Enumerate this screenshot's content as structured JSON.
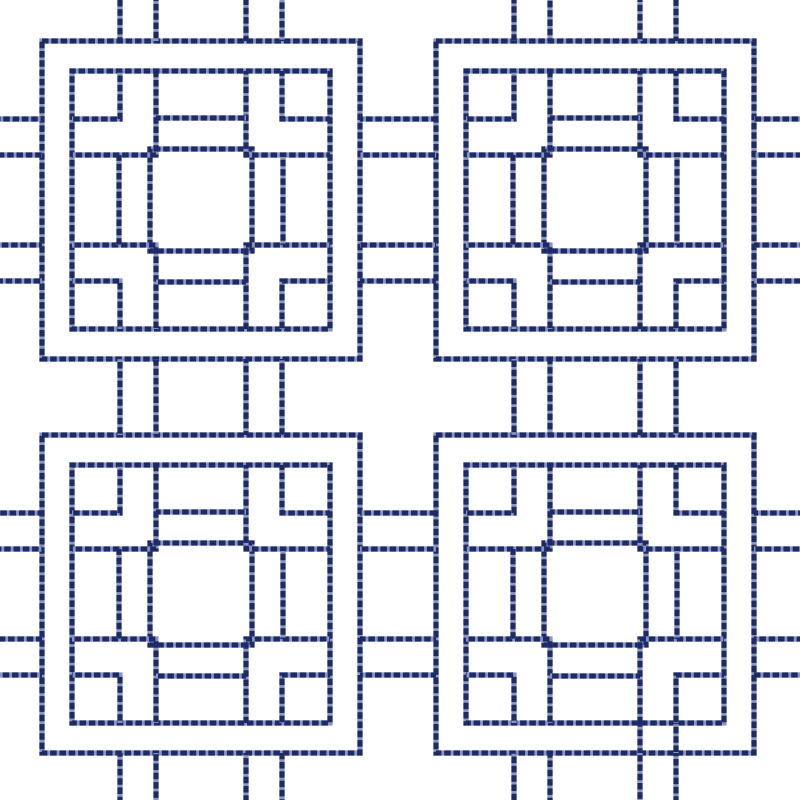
{
  "pattern": {
    "name": "square-maze-lattice-stitch-pattern",
    "background": "#ffffff",
    "viewbox": "0 0 800 800",
    "thread": {
      "dark": "#1d2a66",
      "light": "#8a95c2",
      "width": 5.2,
      "dash_on": 6.5,
      "dash_off": 2.8
    },
    "motif": {
      "size": 318,
      "rects": [
        {
          "name": "outer-square",
          "x": 0,
          "y": 0,
          "w": 318,
          "h": 318
        },
        {
          "name": "inner-ring",
          "x": 30,
          "y": 30,
          "w": 258,
          "h": 258
        },
        {
          "name": "center-square",
          "x": 108,
          "y": 108,
          "w": 102,
          "h": 102
        }
      ],
      "polylines": [
        {
          "name": "corner-key-top-left",
          "pts": [
            [
              30,
              78
            ],
            [
              78,
              78
            ],
            [
              78,
              30
            ]
          ]
        },
        {
          "name": "corner-key-top-right",
          "pts": [
            [
              240,
              30
            ],
            [
              240,
              78
            ],
            [
              288,
              78
            ]
          ]
        },
        {
          "name": "corner-key-bottom-right",
          "pts": [
            [
              288,
              240
            ],
            [
              240,
              240
            ],
            [
              240,
              288
            ]
          ]
        },
        {
          "name": "corner-key-bottom-left",
          "pts": [
            [
              78,
              288
            ],
            [
              78,
              240
            ],
            [
              30,
              240
            ]
          ]
        },
        {
          "name": "rail-top-left",
          "pts": [
            [
              114,
              30
            ],
            [
              114,
              114
            ],
            [
              30,
              114
            ]
          ]
        },
        {
          "name": "rail-top-right",
          "pts": [
            [
              204,
              30
            ],
            [
              204,
              114
            ],
            [
              288,
              114
            ]
          ]
        },
        {
          "name": "rail-bottom-right",
          "pts": [
            [
              288,
              204
            ],
            [
              204,
              204
            ],
            [
              204,
              288
            ]
          ]
        },
        {
          "name": "rail-bottom-left",
          "pts": [
            [
              114,
              288
            ],
            [
              114,
              204
            ],
            [
              30,
              204
            ]
          ]
        }
      ],
      "lines": [
        {
          "name": "rung-top",
          "x1": 114,
          "y1": 77,
          "x2": 204,
          "y2": 77
        },
        {
          "name": "rung-right",
          "x1": 241,
          "y1": 114,
          "x2": 241,
          "y2": 204
        },
        {
          "name": "rung-bottom",
          "x1": 114,
          "y1": 241,
          "x2": 204,
          "y2": 241
        },
        {
          "name": "rung-left",
          "x1": 77,
          "y1": 114,
          "x2": 77,
          "y2": 204
        }
      ]
    },
    "layout": {
      "canvas": 800,
      "origins": [
        [
          42,
          41
        ],
        [
          436,
          41
        ],
        [
          42,
          435
        ],
        [
          436,
          435
        ]
      ],
      "offsets": [
        78,
        114,
        204,
        240
      ],
      "col_x": [
        42,
        436
      ],
      "row_y": [
        41,
        435
      ],
      "h_connector_x": [
        360,
        436
      ],
      "v_connector_y": [
        359,
        435
      ],
      "edge_stub": {
        "top": [
          0,
          41
        ],
        "bottom": [
          753,
          800
        ],
        "left": [
          0,
          42
        ],
        "right": [
          754,
          800
        ]
      },
      "travel_segments": [
        {
          "x1": 640,
          "y1": 723,
          "x2": 640,
          "y2": 753
        },
        {
          "x1": 676,
          "y1": 723,
          "x2": 676,
          "y2": 753
        }
      ]
    }
  }
}
